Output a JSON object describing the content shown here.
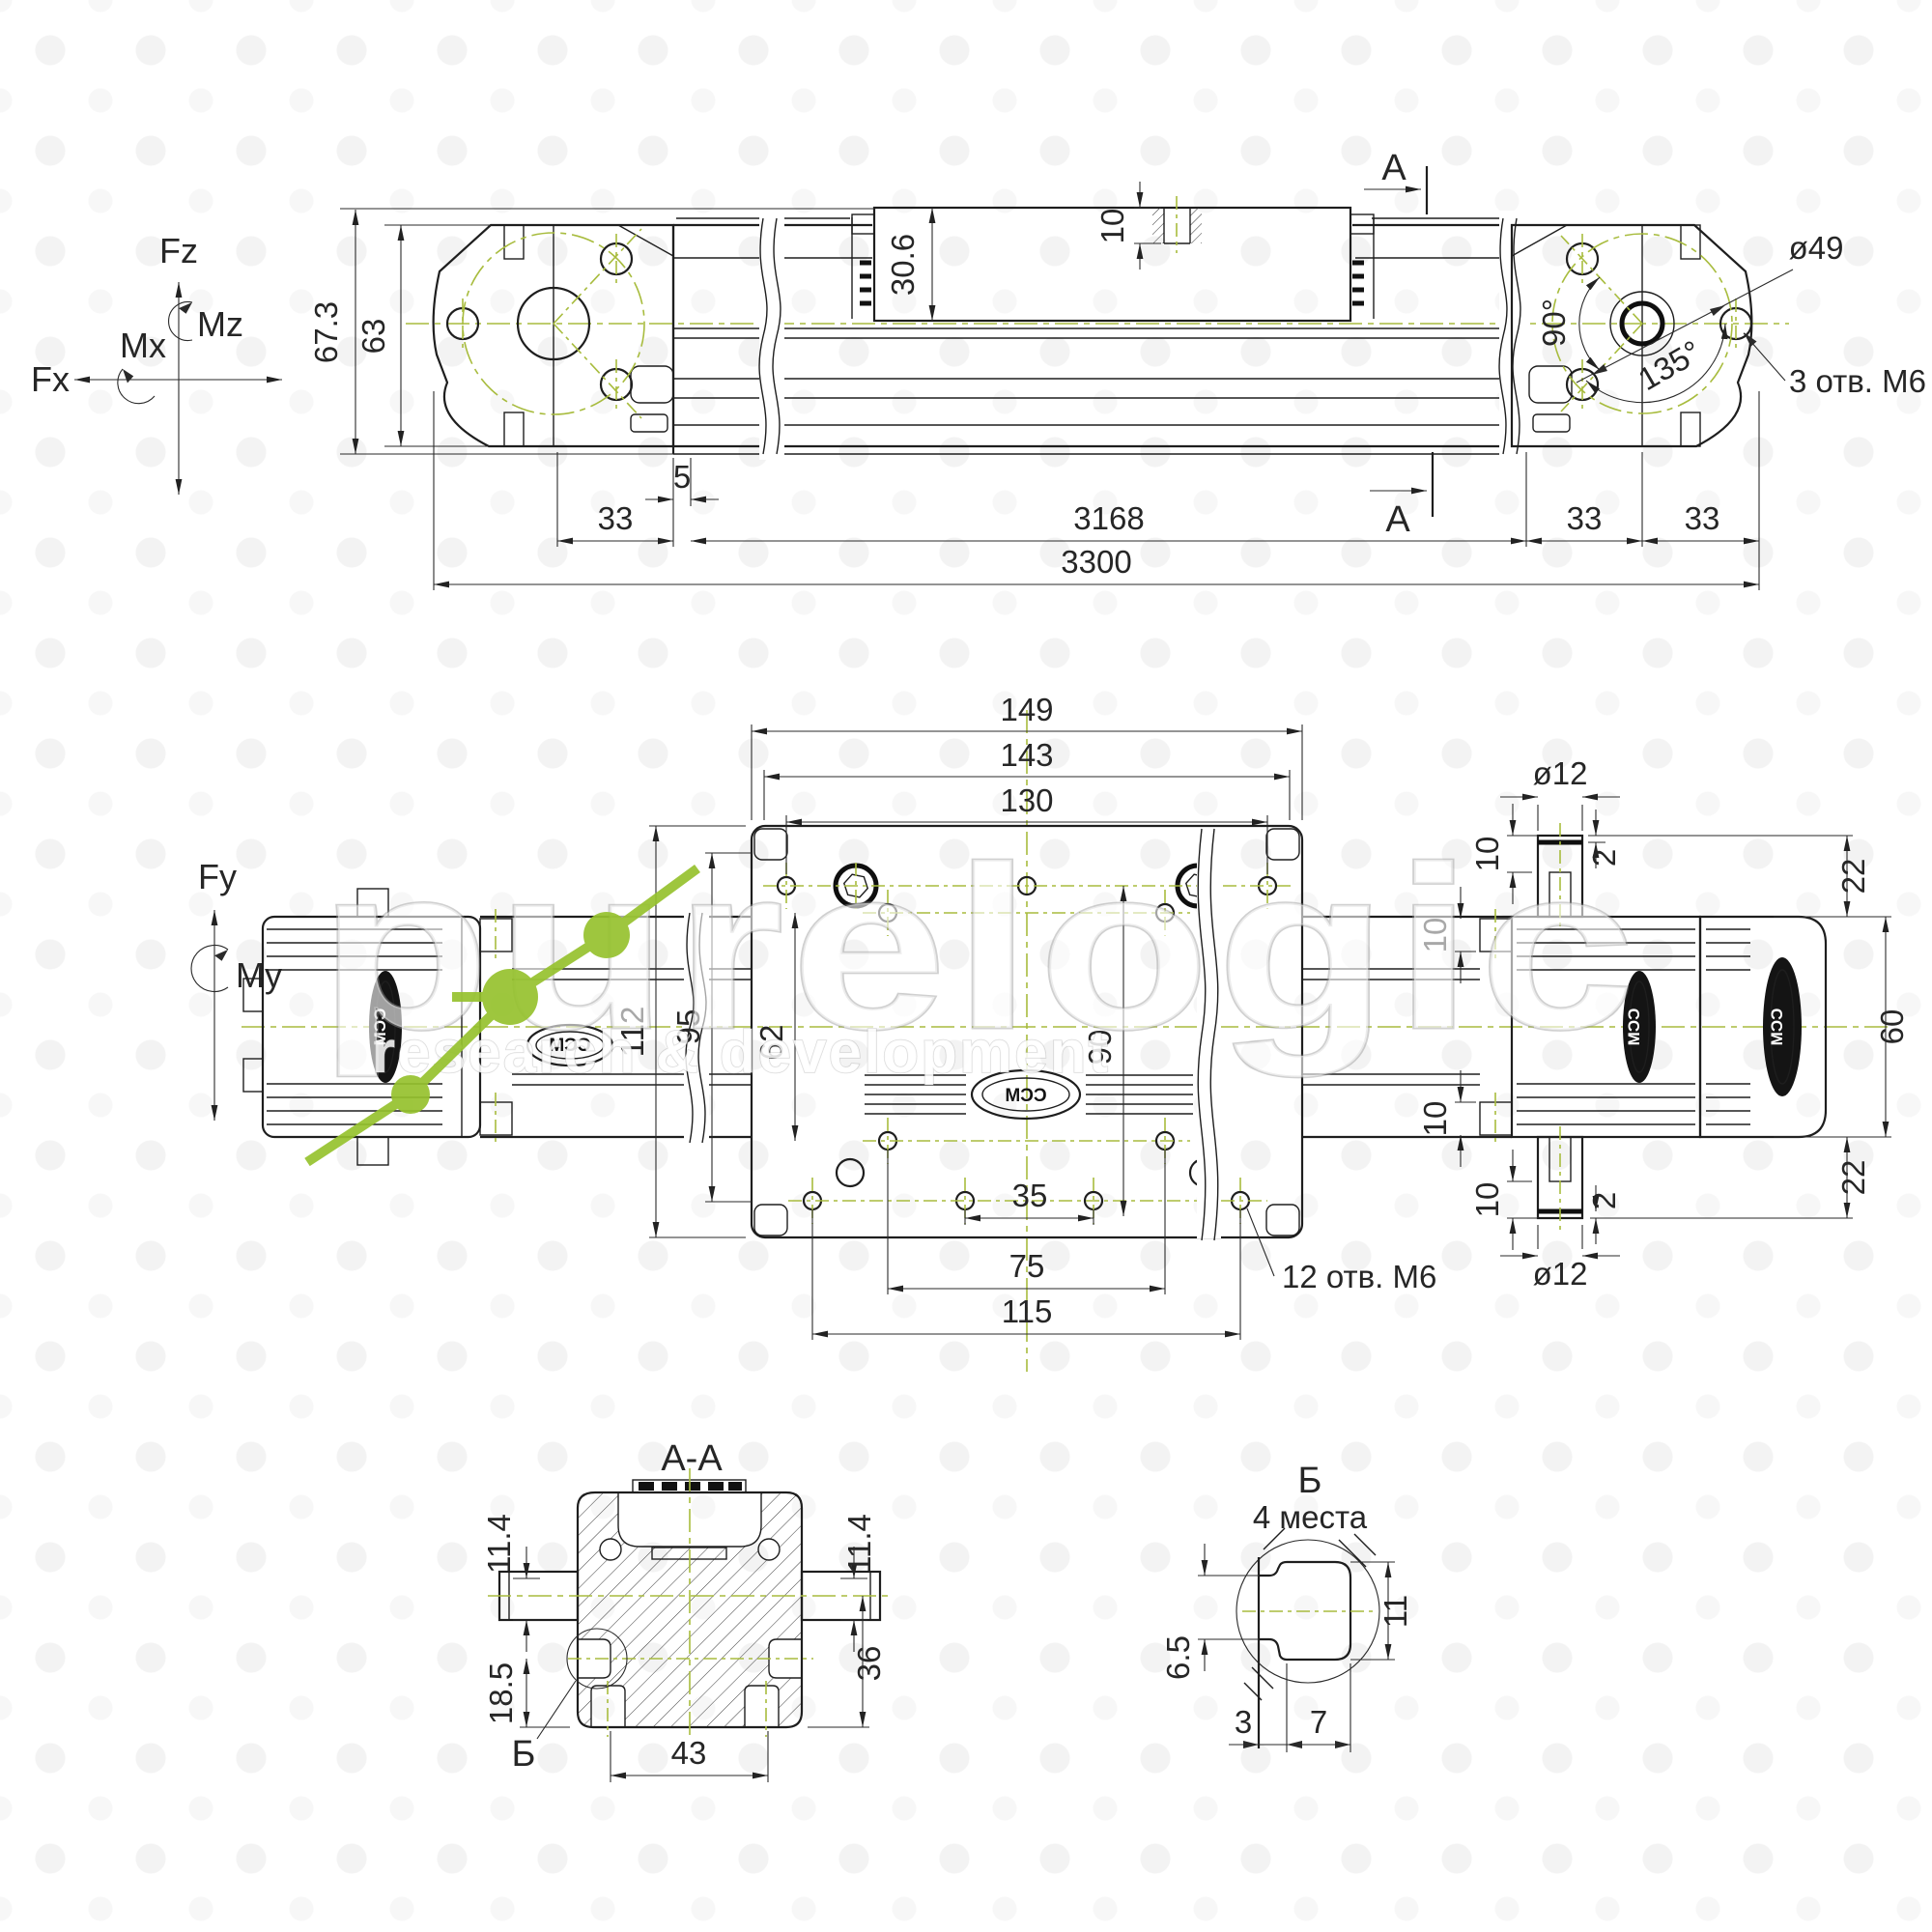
{
  "colors": {
    "line": "#222222",
    "green": "#a8bc3e",
    "watermark_green": "#96c22e"
  },
  "watermark": {
    "brand": "purelogic",
    "subtitle": "research & development"
  },
  "brand_logo": "CCM",
  "axes": {
    "fz": "Fz",
    "mz": "Mz",
    "mx": "Mx",
    "fx": "Fx",
    "fy": "Fy",
    "my": "My"
  },
  "side_view": {
    "section_label": "A",
    "dims": {
      "overall_height": "67.3",
      "body_height": "63",
      "carriage_height": "30.6",
      "thread_depth": "10",
      "offset": "5",
      "pitch_left": "33",
      "stroke": "3168",
      "overall_length": "3300",
      "pitch_right_1": "33",
      "pitch_right_2": "33"
    },
    "flange": {
      "bolt_circle": "ø49",
      "angle_90": "90°",
      "angle_135": "135°",
      "holes_note": "3 отв. M6"
    }
  },
  "plan_view": {
    "holes_note": "12 отв. M6",
    "dims": {
      "plate_length": "149",
      "plate_step": "143",
      "hole_span": "130",
      "plate_width": "112",
      "width_95": "95",
      "width_62": "62",
      "hole_span_90": "90",
      "hole_span_35": "35",
      "hole_span_75": "75",
      "hole_span_115": "115",
      "body_width": "60",
      "edge_top": "22",
      "edge_bottom": "22",
      "step_top": "2",
      "step_bottom": "2",
      "depth_top_1": "10",
      "depth_top_2": "10",
      "depth_bottom_1": "10",
      "depth_bottom_2": "10",
      "shaft_top": "ø12",
      "shaft_bottom": "ø12"
    }
  },
  "section_aa": {
    "title": "A-A",
    "detail_mark": "Б",
    "dims": {
      "left_11_4": "11.4",
      "right_11_4": "11.4",
      "slot_18_5": "18.5",
      "height_36": "36",
      "width_43": "43"
    }
  },
  "detail_b": {
    "title": "Б",
    "places_note": "4 места",
    "dims": {
      "height_11": "11",
      "width_6_5": "6.5",
      "width_3": "3",
      "width_7": "7"
    }
  }
}
